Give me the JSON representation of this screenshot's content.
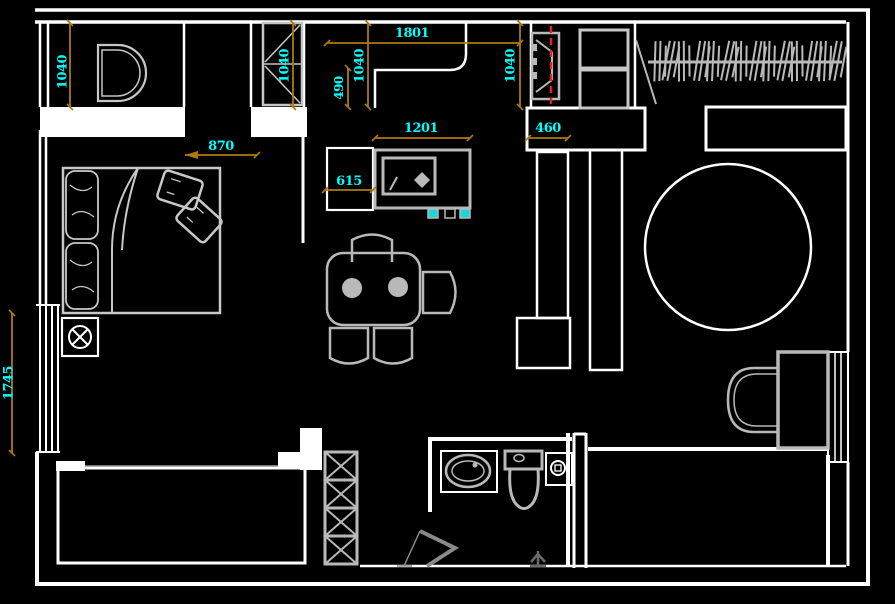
{
  "app": {
    "name": "CAD floor plan view",
    "background": "#000000"
  },
  "colors": {
    "wall": "#ffffff",
    "furniture": "#b9b9b9",
    "dim_line": "#ab7b0a",
    "dim_text": "#00ffff",
    "centerline_red": "#e82222",
    "accent_cyan": "#19d6de",
    "glyph_dark": "#6a6a6a"
  },
  "dims": {
    "entry_closet_width": {
      "value": "1040",
      "orientation": "vertical"
    },
    "hall_cabinet_width": {
      "value": "1040",
      "orientation": "vertical"
    },
    "counter_depth": {
      "value": "490",
      "orientation": "vertical"
    },
    "kitchen_cabinet_width": {
      "value": "1040",
      "orientation": "vertical"
    },
    "counter_length": {
      "value": "1801",
      "orientation": "horizontal"
    },
    "tv_wall_width": {
      "value": "1040",
      "orientation": "vertical"
    },
    "partition_width": {
      "value": "460",
      "orientation": "horizontal"
    },
    "media_cabinet_length": {
      "value": "1201",
      "orientation": "horizontal"
    },
    "fridge_width": {
      "value": "615",
      "orientation": "horizontal"
    },
    "bed_clearance": {
      "value": "870",
      "orientation": "horizontal"
    },
    "bay_window_height": {
      "value": "1745",
      "orientation": "vertical"
    }
  },
  "fixture_icons": [
    "washbasin-icon",
    "tall-cabinet-icon",
    "kitchen-counter-icon",
    "tv-icon",
    "storage-cabinet-icon",
    "clothes-rail-hangers-icon",
    "bed-icon",
    "pillow-icon",
    "cushion-icon",
    "nightstand-icon",
    "fridge-icon",
    "media-unit-icon",
    "dining-table-icon",
    "chair-icon",
    "plate-icon",
    "round-rug-icon",
    "partition-cabinet-icon",
    "vanity-basin-icon",
    "window-icon",
    "toilet-icon",
    "bathroom-sink-icon",
    "floor-drain-icon",
    "shower-door-icon",
    "balcony-icon",
    "lattice-column-icon",
    "door-swing-icon"
  ]
}
